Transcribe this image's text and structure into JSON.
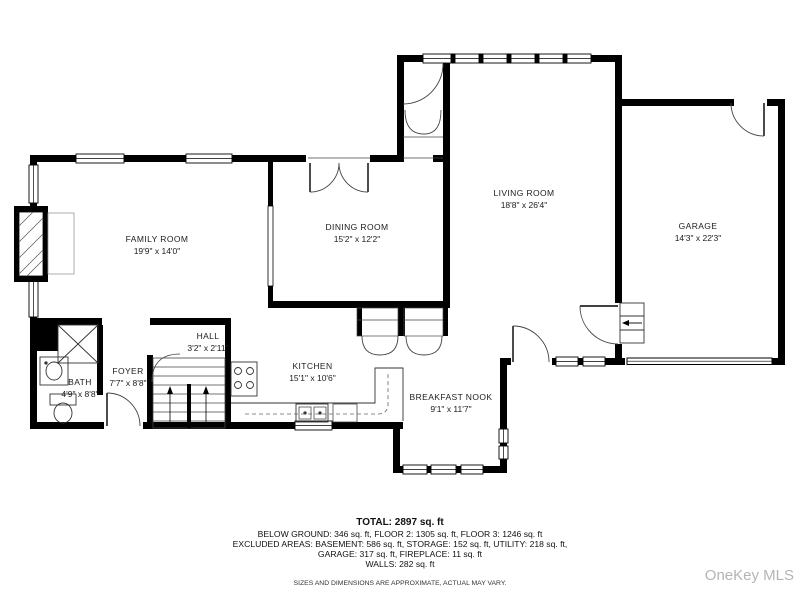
{
  "plan": {
    "rooms": [
      {
        "name": "FAMILY ROOM",
        "dims": "19'9\" x 14'0\""
      },
      {
        "name": "DINING ROOM",
        "dims": "15'2\" x 12'2\""
      },
      {
        "name": "LIVING ROOM",
        "dims": "18'8\" x 26'4\""
      },
      {
        "name": "GARAGE",
        "dims": "14'3\" x 22'3\""
      },
      {
        "name": "BATH",
        "dims": "4'9\" x 8'8\""
      },
      {
        "name": "FOYER",
        "dims": "7'7\" x 8'8\""
      },
      {
        "name": "HALL",
        "dims": "3'2\" x 2'11\""
      },
      {
        "name": "KITCHEN",
        "dims": "15'1\" x 10'6\""
      },
      {
        "name": "BREAKFAST NOOK",
        "dims": "9'1\" x 11'7\""
      }
    ]
  },
  "summary": {
    "total": "TOTAL: 2897 sq. ft",
    "line_floors": "BELOW GROUND: 346 sq. ft, FLOOR 2: 1305 sq. ft, FLOOR 3: 1246 sq. ft",
    "line_excluded": "EXCLUDED AREAS: BASEMENT: 586 sq. ft, STORAGE: 152 sq. ft, UTILITY: 218 sq. ft,",
    "line_garage": "GARAGE: 317 sq. ft, FIREPLACE: 11 sq. ft",
    "line_walls": "WALLS: 282 sq. ft",
    "disclaimer": "SIZES AND DIMENSIONS ARE APPROXIMATE, ACTUAL MAY VARY."
  },
  "watermark": {
    "text": "OneKey MLS",
    "color": "#b4b4b4"
  },
  "colors": {
    "walls": "#000000",
    "fixtures": "#333333",
    "background": "#ffffff"
  }
}
